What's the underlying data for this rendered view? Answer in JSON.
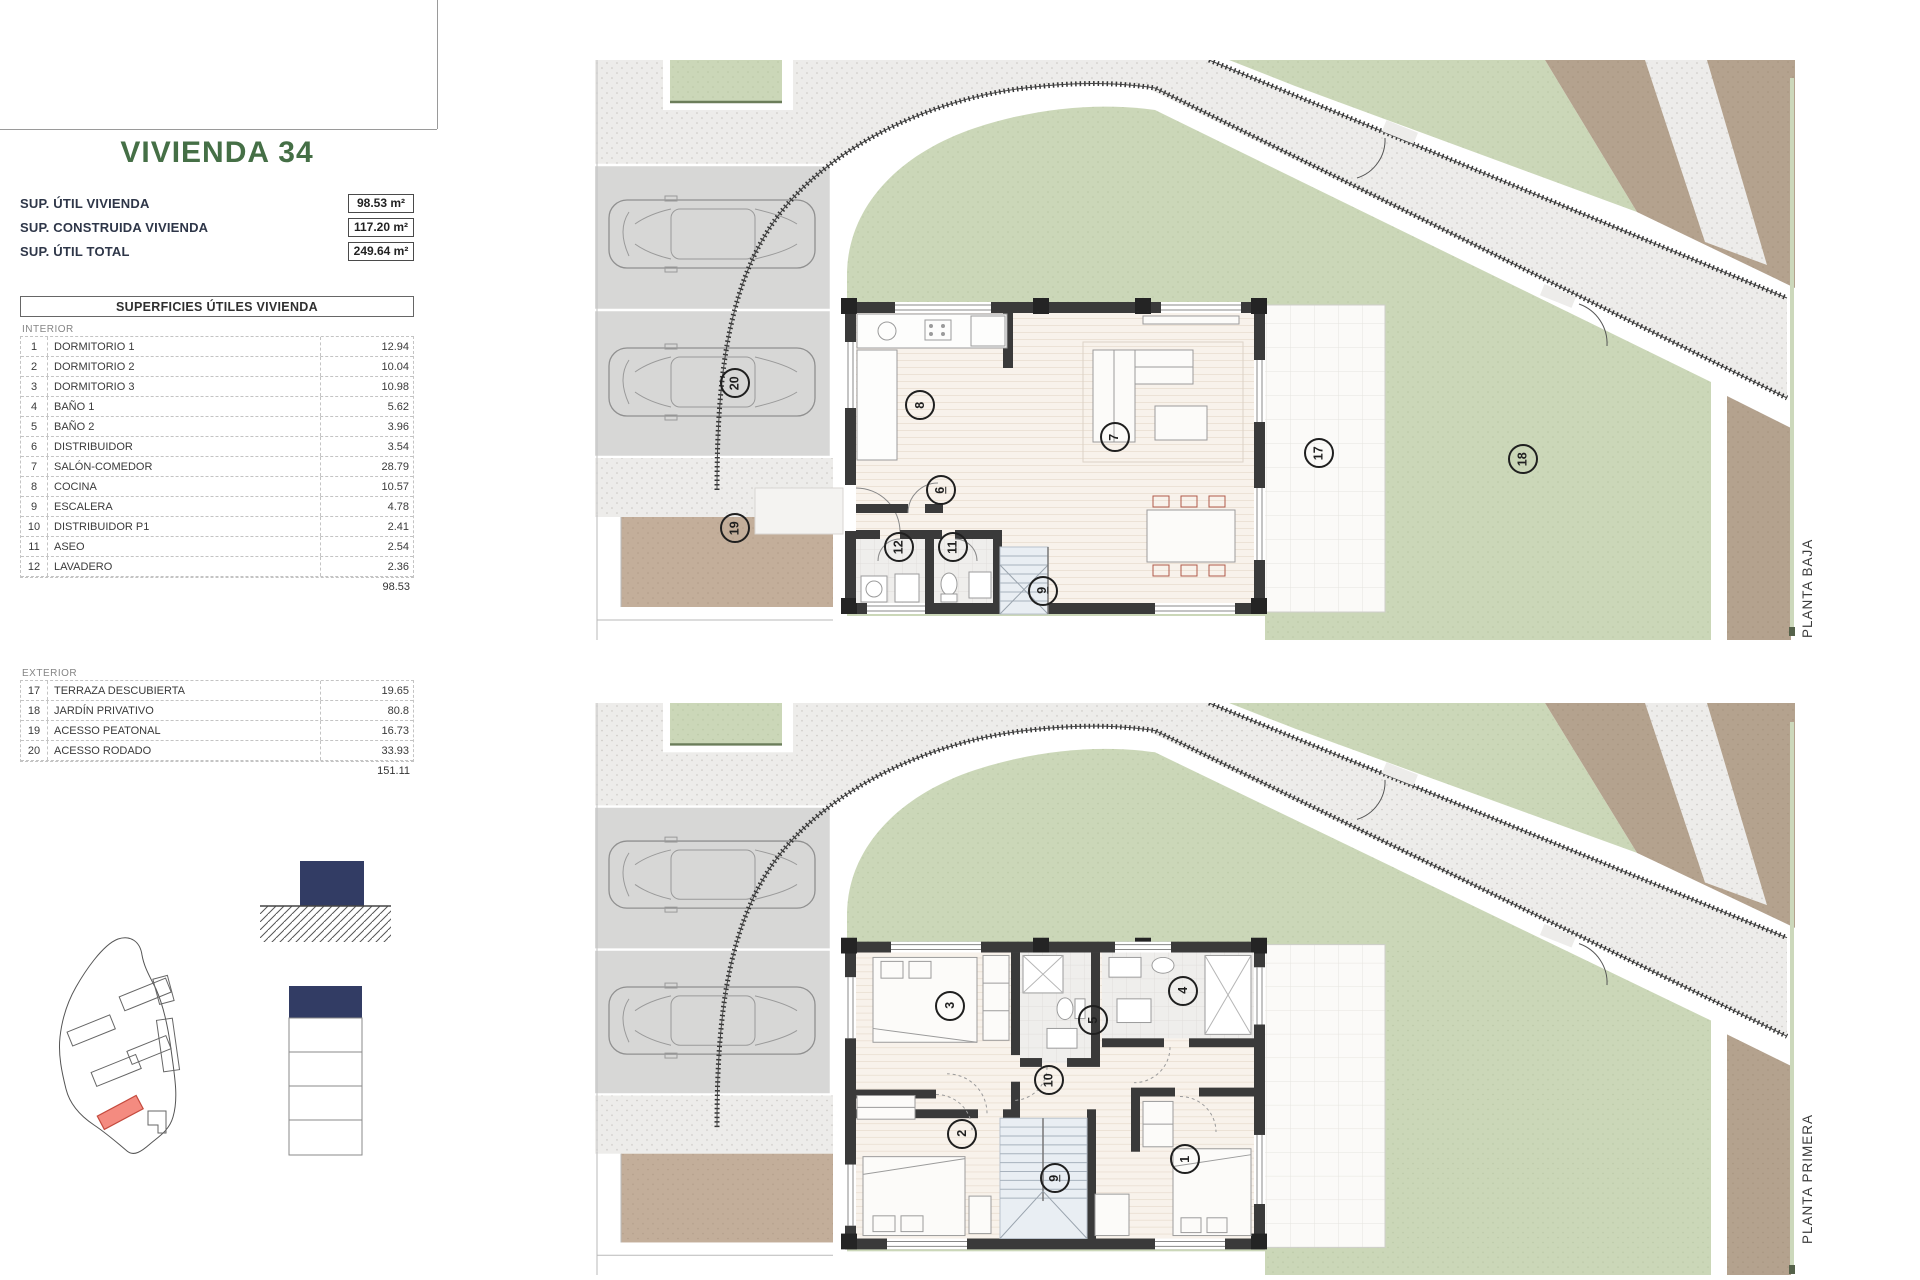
{
  "panel": {
    "title": "VIVIENDA 34",
    "summary": [
      {
        "label": "SUP. ÚTIL VIVIENDA",
        "value": "98.53 m²"
      },
      {
        "label": "SUP. CONSTRUIDA VIVIENDA",
        "value": "117.20 m²"
      },
      {
        "label": "SUP. ÚTIL TOTAL",
        "value": "249.64 m²"
      }
    ],
    "table": {
      "header": "SUPERFICIES ÚTILES VIVIENDA",
      "sections": [
        {
          "name": "INTERIOR",
          "rows": [
            [
              "1",
              "DORMITORIO 1",
              "12.94"
            ],
            [
              "2",
              "DORMITORIO 2",
              "10.04"
            ],
            [
              "3",
              "DORMITORIO 3",
              "10.98"
            ],
            [
              "4",
              "BAÑO 1",
              "5.62"
            ],
            [
              "5",
              "BAÑO 2",
              "3.96"
            ],
            [
              "6",
              "DISTRIBUIDOR",
              "3.54"
            ],
            [
              "7",
              "SALÓN-COMEDOR",
              "28.79"
            ],
            [
              "8",
              "COCINA",
              "10.57"
            ],
            [
              "9",
              "ESCALERA",
              "4.78"
            ],
            [
              "10",
              "DISTRIBUIDOR P1",
              "2.41"
            ],
            [
              "11",
              "ASEO",
              "2.54"
            ],
            [
              "12",
              "LAVADERO",
              "2.36"
            ]
          ],
          "total": "98.53"
        },
        {
          "name": "EXTERIOR",
          "rows": [
            [
              "17",
              "TERRAZA DESCUBIERTA",
              "19.65"
            ],
            [
              "18",
              "JARDÍN PRIVATIVO",
              "80.8"
            ],
            [
              "19",
              "ACESSO PEATONAL",
              "16.73"
            ],
            [
              "20",
              "ACESSO RODADO",
              "33.93"
            ]
          ],
          "total": "151.11"
        }
      ]
    }
  },
  "plans": [
    {
      "id": "planta-baja",
      "label": "PLANTA BAJA",
      "rooms": [
        {
          "n": "8",
          "x": 27.1,
          "y": 59.5
        },
        {
          "n": "7",
          "x": 43.3,
          "y": 65.0
        },
        {
          "n": "6",
          "x": 28.8,
          "y": 74.1,
          "u": true
        },
        {
          "n": "9",
          "x": 37.3,
          "y": 91.5,
          "u": true
        },
        {
          "n": "11",
          "x": 29.8,
          "y": 84.0
        },
        {
          "n": "12",
          "x": 25.3,
          "y": 84.0
        },
        {
          "n": "17",
          "x": 60.3,
          "y": 67.8
        },
        {
          "n": "18",
          "x": 77.3,
          "y": 68.8
        },
        {
          "n": "19",
          "x": 11.7,
          "y": 80.7
        },
        {
          "n": "20",
          "x": 11.7,
          "y": 55.7
        }
      ]
    },
    {
      "id": "planta-primera",
      "label": "PLANTA PRIMERA",
      "rooms": [
        {
          "n": "3",
          "x": 29.6,
          "y": 52.9
        },
        {
          "n": "5",
          "x": 41.5,
          "y": 55.5
        },
        {
          "n": "4",
          "x": 49.0,
          "y": 50.3
        },
        {
          "n": "10",
          "x": 37.8,
          "y": 65.9
        },
        {
          "n": "2",
          "x": 30.6,
          "y": 75.3
        },
        {
          "n": "1",
          "x": 49.2,
          "y": 79.7
        },
        {
          "n": "9",
          "x": 38.3,
          "y": 83.1,
          "u": true
        }
      ]
    }
  ],
  "colors": {
    "title-green": "#456f46",
    "navy": "#323c64",
    "map-red": "#f48b80",
    "map-red-border": "#c44b3e",
    "garden-green": "#cbd7b8",
    "path-beige": "#c3ae9a",
    "plot-brown": "#b4a28e"
  }
}
